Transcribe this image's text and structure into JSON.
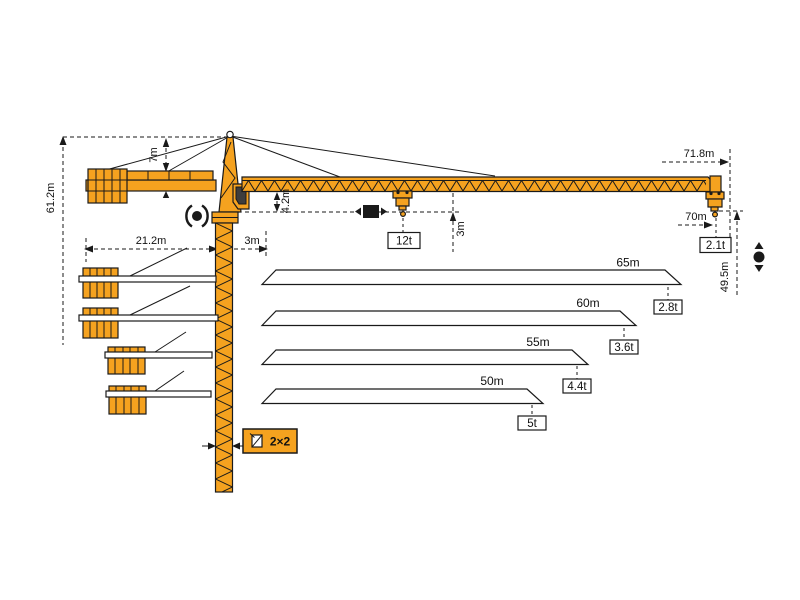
{
  "colors": {
    "crane": "#F5A21F",
    "outline": "#1A1A1A",
    "background": "#FFFFFF"
  },
  "dims": {
    "overall_height": "61.2m",
    "head_height": "7m",
    "counterjib_radius": "21.2m",
    "rear_offset": "3m",
    "jib_clearance": "4.2m",
    "hook_path": "3m",
    "max_radius": "71.8m",
    "hook_radius": "70m",
    "under_hook_height": "49.5m",
    "mast_section": "2×2"
  },
  "loads": {
    "max": "12t",
    "tip": "2.1t"
  },
  "jib_variants": [
    {
      "length": "65m",
      "tip_load": "2.8t"
    },
    {
      "length": "60m",
      "tip_load": "3.6t"
    },
    {
      "length": "55m",
      "tip_load": "4.4t"
    },
    {
      "length": "50m",
      "tip_load": "5t"
    }
  ],
  "icons": {
    "slewing": "rotation-icon",
    "trolley": "trolley-travel-icon",
    "hoist": "hoist-up-down-icon",
    "mast_section": "mast-cross-section-icon"
  }
}
